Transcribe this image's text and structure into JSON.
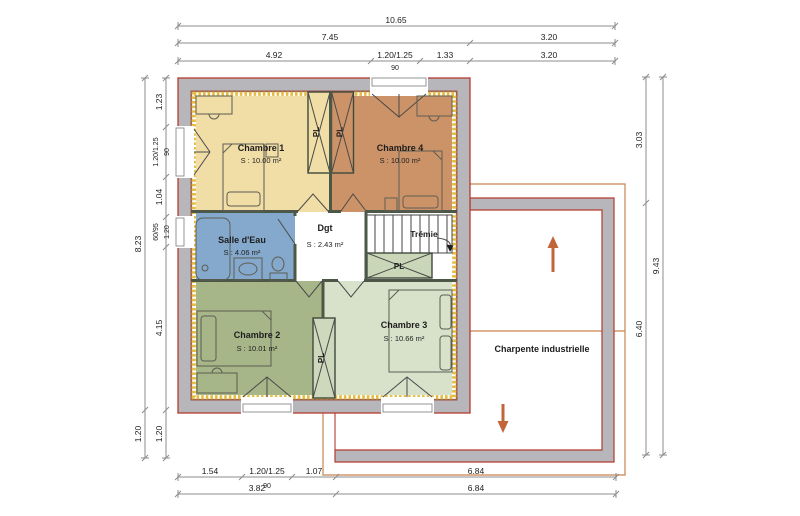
{
  "rooms": {
    "ch1": {
      "name": "Chambre 1",
      "area": "S : 10.00 m²"
    },
    "ch4": {
      "name": "Chambre 4",
      "area": "S : 10.00 m²"
    },
    "sde": {
      "name": "Salle d'Eau",
      "area": "S : 4.06 m²"
    },
    "dgt": {
      "name": "Dgt",
      "area": "S : 2.43 m²"
    },
    "ch2": {
      "name": "Chambre 2",
      "area": "S : 10.01 m²"
    },
    "ch3": {
      "name": "Chambre 3",
      "area": "S : 10.66 m²"
    }
  },
  "labels": {
    "tremie": "Trémie",
    "charpente": "Charpente industrielle",
    "closet": "PL"
  },
  "dims": {
    "top": {
      "total": "10.65",
      "left": "7.45",
      "right": "3.20",
      "w1": "4.92",
      "w2": "1.20/1.25",
      "w3": "1.33",
      "w4": "3.20",
      "sub": "90"
    },
    "left": {
      "total": "8.23",
      "overhang": "1.20",
      "s1": "1.23",
      "s2": "1.20/1.25",
      "s2b": "90",
      "s3": "1.04",
      "s4": "60/95",
      "s4b": "1.20",
      "s5": "4.15",
      "s6": "1.20"
    },
    "right": {
      "total": "9.43",
      "s1": "3.03",
      "s2": "6.40"
    },
    "bottom": {
      "s1": "1.54",
      "s2": "1.20/1.25",
      "s2b": "90",
      "s3": "1.07",
      "s4": "6.84",
      "r2a": "3.82",
      "r2b": "6.84"
    }
  },
  "colors": {
    "wall": "#b7b7bb",
    "wall_outline": "#b23b2e",
    "insulation": "#e5bd44",
    "partition": "#4c5747",
    "chambre1": "#f1dda6",
    "chambre4": "#cd9368",
    "salle_eau": "#84a9cc",
    "degagement": "#ffffff",
    "chambre2": "#a7b689",
    "chambre3": "#d8e2cb",
    "closet_green": "#c9d6b8",
    "closet_mid": "#cdd8bd",
    "roof_line": "#c9854f",
    "arrow": "#c2663a"
  }
}
